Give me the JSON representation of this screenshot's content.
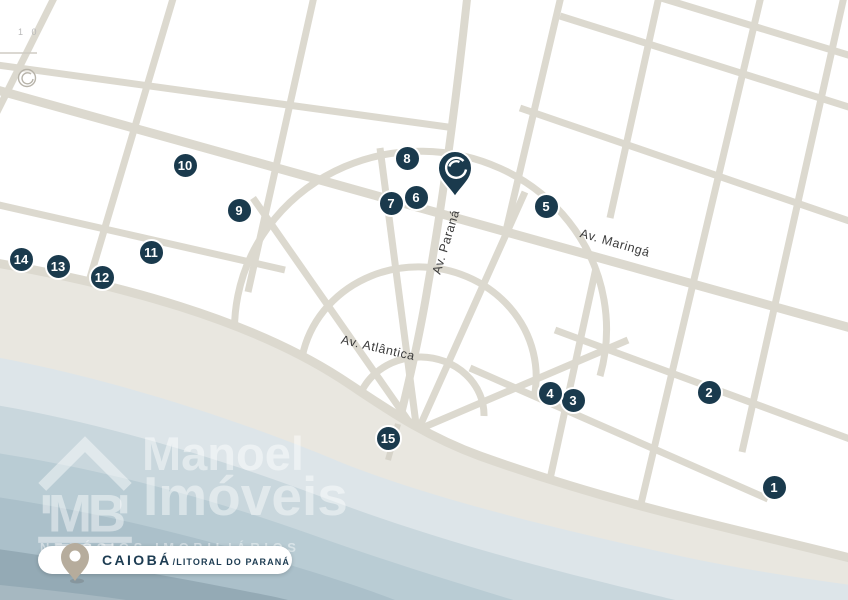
{
  "corner": {
    "ruler_text": "1 0"
  },
  "streets": {
    "parana": "Av. Paraná",
    "maringa": "Av. Maringá",
    "atlantica": "Av. Atlântica"
  },
  "markers": [
    {
      "label": "1",
      "x": 774,
      "y": 487
    },
    {
      "label": "2",
      "x": 709,
      "y": 392
    },
    {
      "label": "3",
      "x": 573,
      "y": 400
    },
    {
      "label": "4",
      "x": 550,
      "y": 393
    },
    {
      "label": "5",
      "x": 546,
      "y": 206
    },
    {
      "label": "6",
      "x": 416,
      "y": 197
    },
    {
      "label": "7",
      "x": 391,
      "y": 203
    },
    {
      "label": "8",
      "x": 407,
      "y": 158
    },
    {
      "label": "9",
      "x": 239,
      "y": 210
    },
    {
      "label": "10",
      "x": 185,
      "y": 165
    },
    {
      "label": "11",
      "x": 151,
      "y": 252
    },
    {
      "label": "12",
      "x": 102,
      "y": 277
    },
    {
      "label": "13",
      "x": 58,
      "y": 266
    },
    {
      "label": "14",
      "x": 21,
      "y": 259
    },
    {
      "label": "15",
      "x": 388,
      "y": 438
    }
  ],
  "logo": {
    "monogram": "MB",
    "line1": "Manoel",
    "line2": "Imóveis",
    "tagline": "NEGÓCIOS IMOBILIÁRIOS"
  },
  "badge": {
    "city": "CAIOBÁ",
    "region": "/LITORAL DO PARANÁ"
  },
  "colors": {
    "marker": "#1a3a4d",
    "street": "#dcd9cf",
    "sand": "#e9e7e0",
    "navy": "#1d3c52",
    "ocean_bands": [
      "#dde5e9",
      "#c9d7dd",
      "#b9ccd4",
      "#abc0ca",
      "#94aab5",
      "#a6b8c1"
    ]
  }
}
